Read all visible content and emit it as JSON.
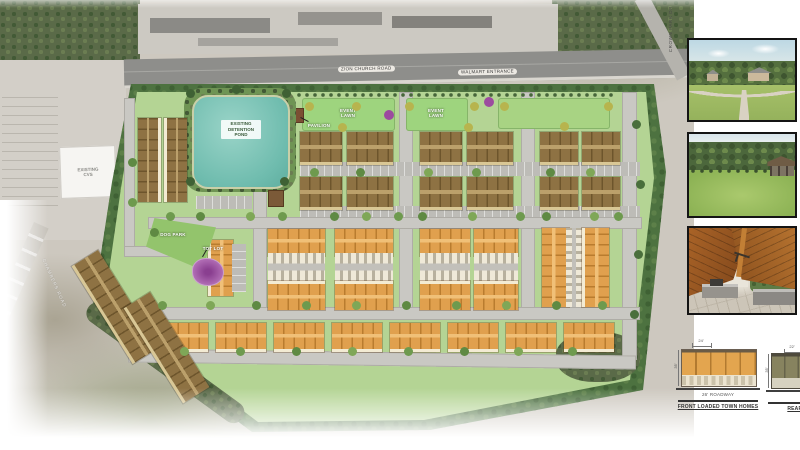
{
  "roads": {
    "main_road_label": "ZION CHURCH ROAD",
    "entrance_label": "WALMART ENTRANCE",
    "crown_park_label": "CROWN PARK DR",
    "left_road_label": "CHAMBERS ROAD"
  },
  "site": {
    "pond_label": "EXISTING DETENTION POND",
    "existing_store_label": "EXISTING CVS",
    "pavilion_label": "PAVILION",
    "event_lawn_label": "EVENT LAWN",
    "dog_park_label": "DOG PARK",
    "tot_lot_label": "TOT LOT"
  },
  "elevations": {
    "front": {
      "width_dim": "24'",
      "height_dim": "35'",
      "street_label": "26' ROADWAY",
      "title": "FRONT LOADED TOWN HOMES"
    },
    "rear": {
      "width_dim": "22'",
      "height_dim": "35'",
      "street_label": "20' ALLEY",
      "title": "REAR LOADED TOWN HOMES"
    }
  },
  "colors": {
    "pond": "#7ec4b6",
    "site_green": "#b4d494",
    "buffer_green": "#4d7240",
    "townhome_front_orange": "#e0a04e",
    "townhome_rear_brown": "#8e7243",
    "road_gray": "#c9c8c3",
    "tot_lot_purple": "#a557a8"
  }
}
